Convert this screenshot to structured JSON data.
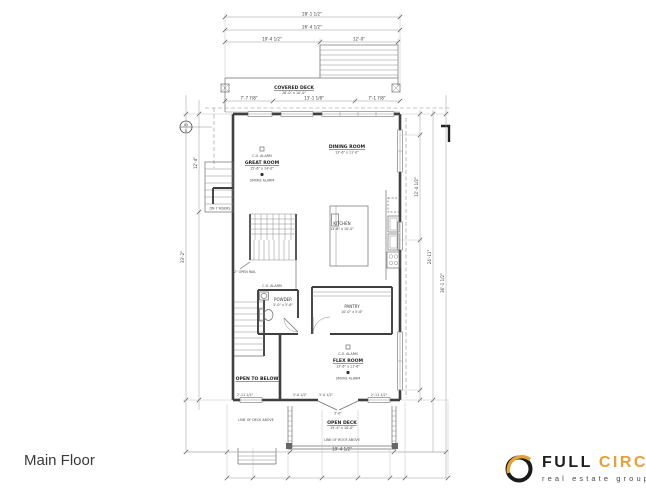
{
  "page": {
    "title": "Main Floor"
  },
  "logo": {
    "word1": "FULL",
    "word2": "CIRCLE",
    "tagline": "real estate group"
  },
  "colors": {
    "accent_gold": "#E2A23B",
    "ink": "#1d1d1d",
    "wall": "#3f3f3f",
    "dimline": "#9a9a9a"
  },
  "rooms": {
    "covered_deck": {
      "name": "COVERED DECK",
      "dim": "28'-0\" x 10'-0\""
    },
    "great_room": {
      "name": "GREAT ROOM",
      "dim": "15'-6\" x 14'-0\""
    },
    "dining_room": {
      "name": "DINING ROOM",
      "dim": "13'-6\" x 11'-0\""
    },
    "kitchen": {
      "name": "KITCHEN",
      "dim": "13'-6\" x 10'-0\""
    },
    "powder": {
      "name": "POWDER",
      "dim": "5'-0\" x 5'-6\""
    },
    "pantry": {
      "name": "PANTRY",
      "dim": "10'-0\" x 5'-6\""
    },
    "flex_room": {
      "name": "FLEX ROOM",
      "dim": "13'-6\" x 11'-6\""
    },
    "open_to_below": {
      "name": "OPEN TO BELOW"
    },
    "open_deck": {
      "name": "OPEN DECK",
      "dim": "19'-4\" x 10'-0\""
    }
  },
  "annotations": {
    "co_alarm": "C.O. ALARM",
    "smoke_alarm": "SMOKE ALARM",
    "roof_above": "LINE OF ROOF ABOVE",
    "deck_above": "LINE OF DECK ABOVE",
    "dn_risers": "DN 7 RISERS",
    "stair_note": "42\" OPEN RAIL",
    "marker_top": "A5",
    "marker_bottom": "8"
  },
  "dims": {
    "top1": "28'-1 1/2\"",
    "top2": "26'-4 1/2\"",
    "top3a": "19'-4 1/2\"",
    "top3b": "12'-0\"",
    "deck1": "7'-7 7/8\"",
    "deck2": "13'-1 1/8\"",
    "deck3": "7'-1 7/8\"",
    "left1": "33'-2\"",
    "left2": "12'-4\"",
    "right1": "24'-11\"",
    "right2": "36'-1 1/2\"",
    "right3": "12'-4 1/2\"",
    "bottom1": "19'-4 1/2\"",
    "door1": "2'-11 1/2\"",
    "door2": "3'-0 1/2\"",
    "door3": "3'-0 1/2\"",
    "door4": "2'-11 1/2\"",
    "door_center": "5'-0\""
  }
}
